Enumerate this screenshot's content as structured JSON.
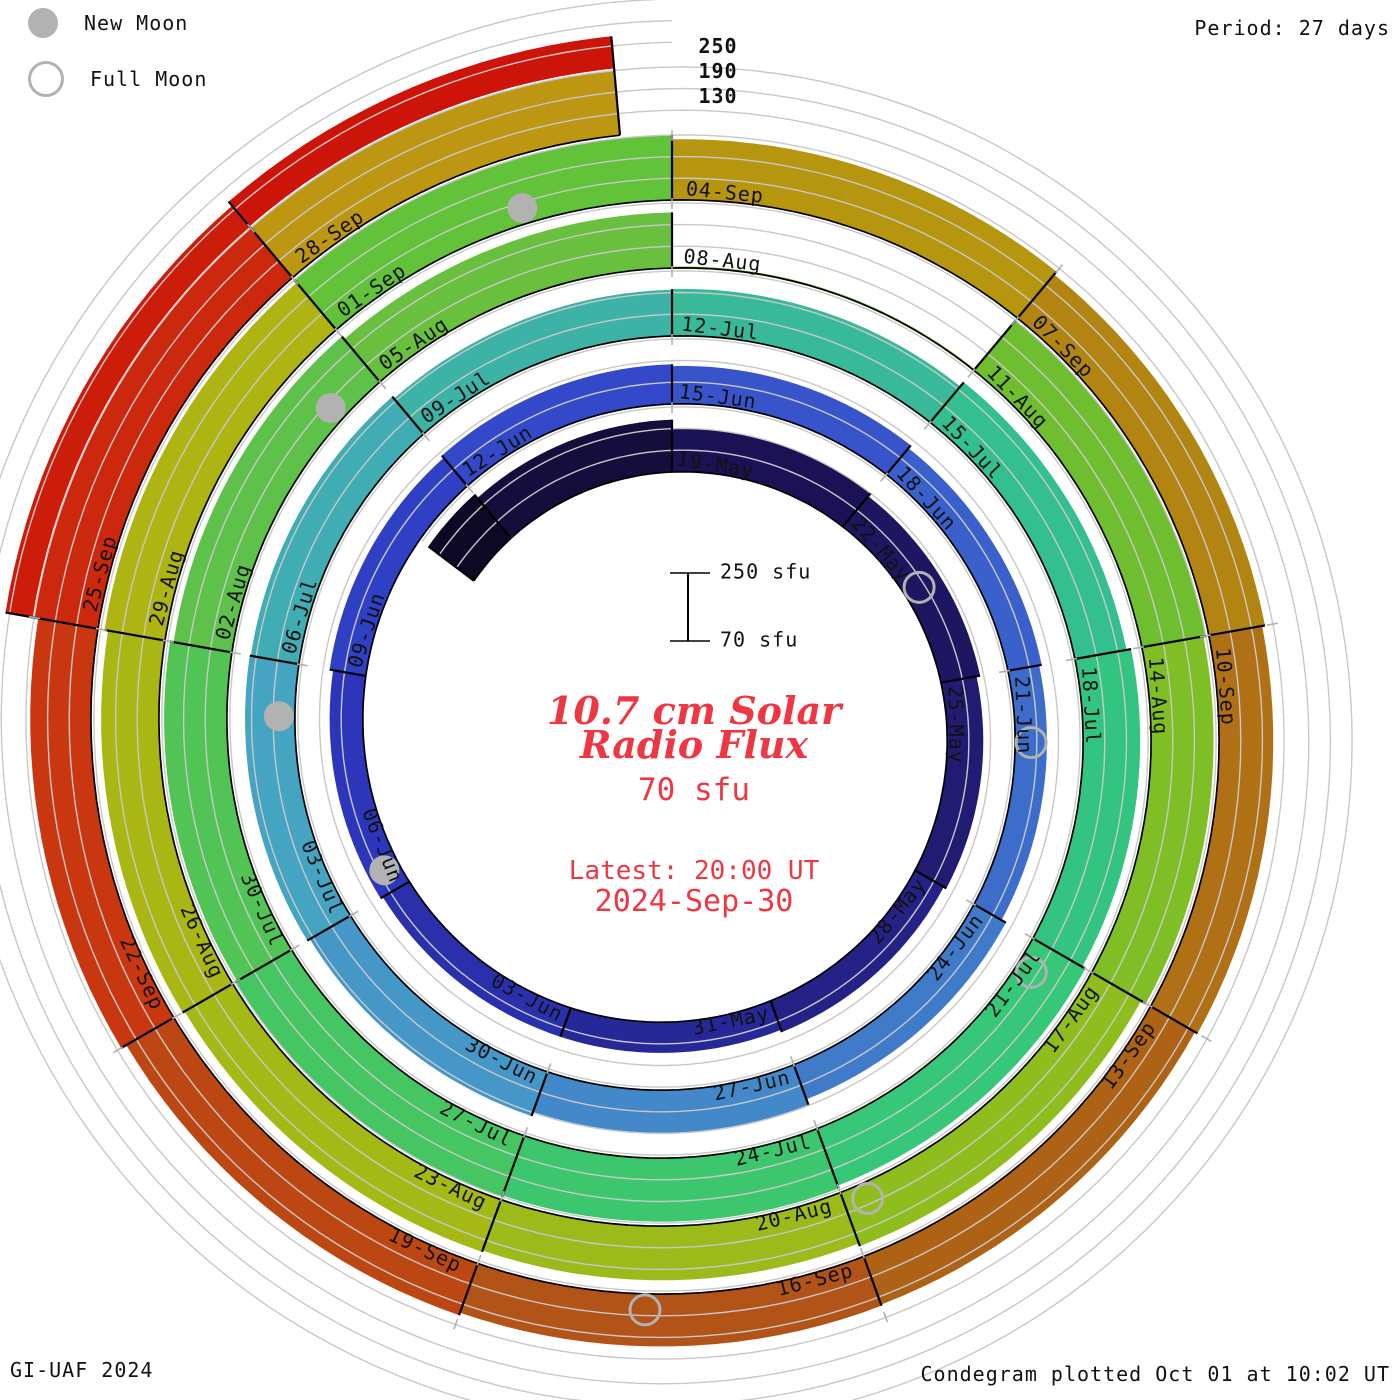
{
  "legend": {
    "new_moon": "New Moon",
    "full_moon": "Full Moon"
  },
  "period_label": "Period: 27 days",
  "credit": "GI-UAF 2024",
  "plotted": "Condegram plotted Oct 01 at 10:02 UT",
  "top_scale_numbers": [
    "250",
    "190",
    "130"
  ],
  "center": {
    "title_line1": "10.7 cm Solar",
    "title_line2": "Radio Flux",
    "value": "70 sfu",
    "latest_prefix": "Latest: 20:00 UT",
    "latest_date": "2024-Sep-30"
  },
  "scale_widget": {
    "top_label": "250 sfu",
    "bottom_label": "70 sfu"
  },
  "colors": {
    "grid": "#c8c8c8",
    "tick": "#b0b0b0",
    "moon": "#b2b2b2",
    "outline": "#000000",
    "label_text": "#111111",
    "annotation_red": "#ee3742"
  },
  "chart_data": {
    "type": "bar",
    "layout": "polar-spiral-condegram",
    "title": "10.7 cm Solar Radio Flux",
    "units": "sfu",
    "period_days": 27,
    "segment_days": 3,
    "ylim": [
      70,
      250
    ],
    "gridline_values": [
      130,
      190,
      250
    ],
    "geometry": {
      "cx": 672,
      "cy": 730,
      "r0": 258,
      "pitch": 68,
      "hmax": 65,
      "start_deg": -53,
      "end_deg": 1795,
      "grid_start_deg": -53,
      "grid_end_deg": 2160,
      "label_radial_offset": 8,
      "moon_radial_offset": 16,
      "moon_radius": 15,
      "scale_widget": {
        "x": 688,
        "y_top": 573,
        "y_bot": 641,
        "tick_half": 18
      }
    },
    "segments": [
      {
        "label": "",
        "start_deg": -53,
        "bars": [
          [
            228,
            "#0c0825"
          ]
        ]
      },
      {
        "label": "",
        "start_deg": -40,
        "bars": [
          [
            215,
            "#130e3c"
          ]
        ]
      },
      {
        "label": "19-May",
        "start_deg": 0,
        "bars": [
          [
            190,
            "#1a1254"
          ]
        ]
      },
      {
        "label": "22-May",
        "start_deg": 40,
        "bars": [
          [
            180,
            "#1d1660"
          ]
        ]
      },
      {
        "label": "25-May",
        "start_deg": 80,
        "bars": [
          [
            170,
            "#211c72"
          ]
        ]
      },
      {
        "label": "28-May",
        "start_deg": 120,
        "bars": [
          [
            162,
            "#242286"
          ]
        ]
      },
      {
        "label": "31-May",
        "start_deg": 160,
        "bars": [
          [
            155,
            "#272898"
          ]
        ]
      },
      {
        "label": "03-Jun",
        "start_deg": 200,
        "bars": [
          [
            155,
            "#2a2fac"
          ]
        ]
      },
      {
        "label": "06-Jun",
        "start_deg": 240,
        "bars": [
          [
            162,
            "#2d36ba"
          ]
        ]
      },
      {
        "label": "09-Jun",
        "start_deg": 280,
        "bars": [
          [
            172,
            "#3040c5"
          ]
        ]
      },
      {
        "label": "12-Jun",
        "start_deg": 320,
        "bars": [
          [
            180,
            "#3349c9"
          ]
        ]
      },
      {
        "label": "15-Jun",
        "start_deg": 360,
        "bars": [
          [
            175,
            "#3754cb"
          ]
        ]
      },
      {
        "label": "18-Jun",
        "start_deg": 400,
        "bars": [
          [
            165,
            "#3a60cb"
          ]
        ]
      },
      {
        "label": "21-Jun",
        "start_deg": 440,
        "bars": [
          [
            158,
            "#3d6dca"
          ]
        ]
      },
      {
        "label": "24-Jun",
        "start_deg": 480,
        "bars": [
          [
            172,
            "#407bca"
          ]
        ]
      },
      {
        "label": "27-Jun",
        "start_deg": 520,
        "bars": [
          [
            188,
            "#4389c9"
          ]
        ]
      },
      {
        "label": "30-Jun",
        "start_deg": 560,
        "bars": [
          [
            200,
            "#4597c8"
          ]
        ]
      },
      {
        "label": "03-Jul",
        "start_deg": 600,
        "bars": [
          [
            208,
            "#44a4c1"
          ]
        ]
      },
      {
        "label": "06-Jul",
        "start_deg": 640,
        "bars": [
          [
            205,
            "#40acb4"
          ]
        ]
      },
      {
        "label": "09-Jul",
        "start_deg": 680,
        "bars": [
          [
            198,
            "#3cb3a6"
          ]
        ]
      },
      {
        "label": "12-Jul",
        "start_deg": 720,
        "bars": [
          [
            200,
            "#38b99a"
          ]
        ]
      },
      {
        "label": "15-Jul",
        "start_deg": 760,
        "bars": [
          [
            215,
            "#34bf8e"
          ]
        ]
      },
      {
        "label": "18-Jul",
        "start_deg": 800,
        "bars": [
          [
            228,
            "#33c482"
          ]
        ]
      },
      {
        "label": "21-Jul",
        "start_deg": 840,
        "bars": [
          [
            238,
            "#36c778"
          ]
        ]
      },
      {
        "label": "24-Jul",
        "start_deg": 880,
        "bars": [
          [
            246,
            "#3cc76e"
          ]
        ]
      },
      {
        "label": "27-Jul",
        "start_deg": 920,
        "bars": [
          [
            250,
            "#46c662"
          ]
        ]
      },
      {
        "label": "30-Jul",
        "start_deg": 960,
        "bars": [
          [
            244,
            "#52c455"
          ]
        ]
      },
      {
        "label": "02-Aug",
        "start_deg": 1000,
        "bars": [
          [
            234,
            "#5ec24a"
          ]
        ]
      },
      {
        "label": "05-Aug",
        "start_deg": 1040,
        "bars": [
          [
            224,
            "#68c03e"
          ]
        ]
      },
      {
        "label": "08-Aug",
        "start_deg": 1080,
        "bars": [
          [
            74,
            "#70be34"
          ]
        ]
      },
      {
        "label": "11-Aug",
        "start_deg": 1120,
        "bars": [
          [
            250,
            "#6fbe30"
          ]
        ]
      },
      {
        "label": "14-Aug",
        "start_deg": 1160,
        "bars": [
          [
            243,
            "#80be26"
          ]
        ]
      },
      {
        "label": "17-Aug",
        "start_deg": 1200,
        "bars": [
          [
            228,
            "#90bd1e"
          ]
        ]
      },
      {
        "label": "20-Aug",
        "start_deg": 1240,
        "bars": [
          [
            220,
            "#9cba1a"
          ]
        ]
      },
      {
        "label": "23-Aug",
        "start_deg": 1280,
        "bars": [
          [
            224,
            "#a4b916"
          ]
        ]
      },
      {
        "label": "26-Aug",
        "start_deg": 1320,
        "bars": [
          [
            230,
            "#aab614"
          ]
        ]
      },
      {
        "label": "29-Aug",
        "start_deg": 1360,
        "bars": [
          [
            240,
            "#aeb412"
          ]
        ]
      },
      {
        "label": "01-Sep",
        "start_deg": 1400,
        "bars": [
          [
            250,
            "#62c23a"
          ]
        ]
      },
      {
        "label": "04-Sep",
        "start_deg": 1440,
        "bars": [
          [
            238,
            "#b6950f"
          ]
        ]
      },
      {
        "label": "07-Sep",
        "start_deg": 1480,
        "bars": [
          [
            228,
            "#b28512"
          ]
        ]
      },
      {
        "label": "10-Sep",
        "start_deg": 1520,
        "bars": [
          [
            220,
            "#b07016"
          ]
        ]
      },
      {
        "label": "13-Sep",
        "start_deg": 1560,
        "bars": [
          [
            212,
            "#ad6215"
          ]
        ]
      },
      {
        "label": "16-Sep",
        "start_deg": 1600,
        "bars": [
          [
            215,
            "#b25317"
          ]
        ]
      },
      {
        "label": "19-Sep",
        "start_deg": 1640,
        "bars": [
          [
            222,
            "#bd4713"
          ]
        ]
      },
      {
        "label": "22-Sep",
        "start_deg": 1680,
        "bars": [
          [
            238,
            "#c93711"
          ]
        ]
      },
      {
        "label": "25-Sep",
        "start_deg": 1720,
        "bars": [
          [
            248,
            "#cc280d"
          ],
          [
            330,
            "#cc1c0a"
          ]
        ]
      },
      {
        "label": "28-Sep",
        "start_deg": 1760,
        "bars": [
          [
            250,
            "#bd9612"
          ],
          [
            345,
            "#cc1408"
          ]
        ]
      }
    ],
    "moons": [
      {
        "type": "full",
        "date": "23-May",
        "day": 4.5
      },
      {
        "type": "new",
        "date": "06-Jun",
        "day": 18.3
      },
      {
        "type": "full",
        "date": "22-Jun",
        "day": 33.9
      },
      {
        "type": "new",
        "date": "05-Jul",
        "day": 47.4
      },
      {
        "type": "full",
        "date": "21-Jul",
        "day": 63.3
      },
      {
        "type": "new",
        "date": "04-Aug",
        "day": 77.5
      },
      {
        "type": "full",
        "date": "19-Aug",
        "day": 92.8
      },
      {
        "type": "new",
        "date": "02-Sep",
        "day": 106.8
      },
      {
        "type": "full",
        "date": "17-Sep",
        "day": 121.7
      }
    ]
  }
}
